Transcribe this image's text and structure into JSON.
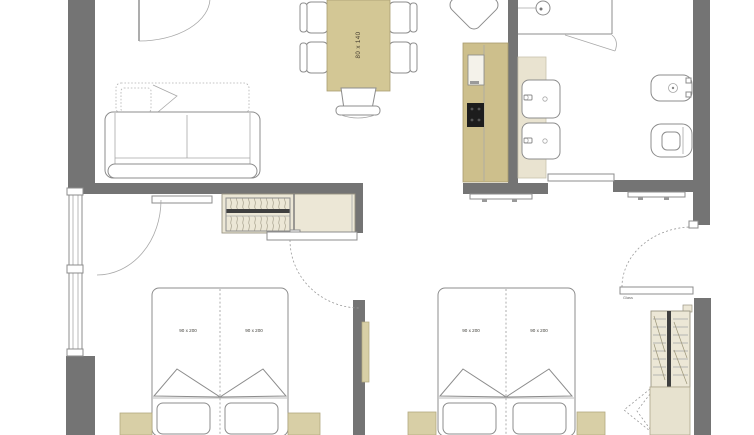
{
  "labels": {
    "dining_table_size": "80 x 140",
    "bed1_left_size": "90 x 200",
    "bed1_right_size": "90 x 200",
    "bed2_left_size": "90 x 200",
    "bed2_right_size": "90 x 200",
    "right_door": "Glass"
  },
  "colors": {
    "background": "#ffffff",
    "wall": "#747474",
    "furniture_tan": "#d3c795",
    "kitchen_tan": "#cdbf8c",
    "cabinet_light": "#ece7d6",
    "counter_light": "#e9e3d0",
    "nightstand_tan": "#d8cfa6",
    "cooktop_black": "#1d1d1d",
    "outline": "#8c8c8c"
  }
}
